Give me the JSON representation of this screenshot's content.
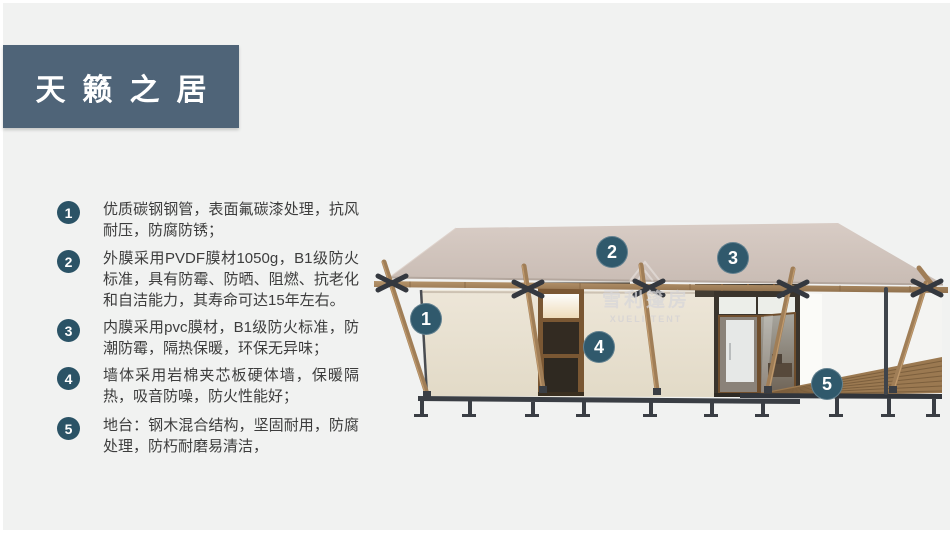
{
  "header": {
    "title": "天籁之居"
  },
  "features": [
    {
      "number": "1",
      "text": "优质碳钢钢管，表面氟碳漆处理，抗风耐压，防腐防锈；"
    },
    {
      "number": "2",
      "text": "外膜采用PVDF膜材1050g，B1级防火标准，具有防霉、防晒、阻燃、抗老化和自洁能力，其寿命可达15年左右。"
    },
    {
      "number": "3",
      "text": "内膜采用pvc膜材，B1级防火标准，防潮防霉，隔热保暖，环保无异味；"
    },
    {
      "number": "4",
      "text": "墙体采用岩棉夹芯板硬体墙，保暖隔热，吸音防噪，防火性能好；"
    },
    {
      "number": "5",
      "text": "地台：钢木混合结构，坚固耐用，防腐处理，防朽耐磨易清洁，"
    }
  ],
  "illustration": {
    "subject": "glamping-tent-cabin-3d-render",
    "callouts": [
      {
        "number": "1"
      },
      {
        "number": "2"
      },
      {
        "number": "3"
      },
      {
        "number": "4"
      },
      {
        "number": "5"
      }
    ],
    "watermark": {
      "cn": "雪利篷房",
      "en": "XUELI TENT"
    }
  },
  "colors": {
    "background": "#f1f2f1",
    "frame": "#ffffff",
    "title_bar": "#4f6478",
    "title_text": "#ffffff",
    "list_badge": "#2b5366",
    "image_badge": "#30596c",
    "body_text": "#3d3d3d",
    "roof": "#d3c7bf",
    "wall": "#eae3d3",
    "wood": "#a07e57",
    "steel": "#3c4046",
    "deck": "#9b7951"
  }
}
